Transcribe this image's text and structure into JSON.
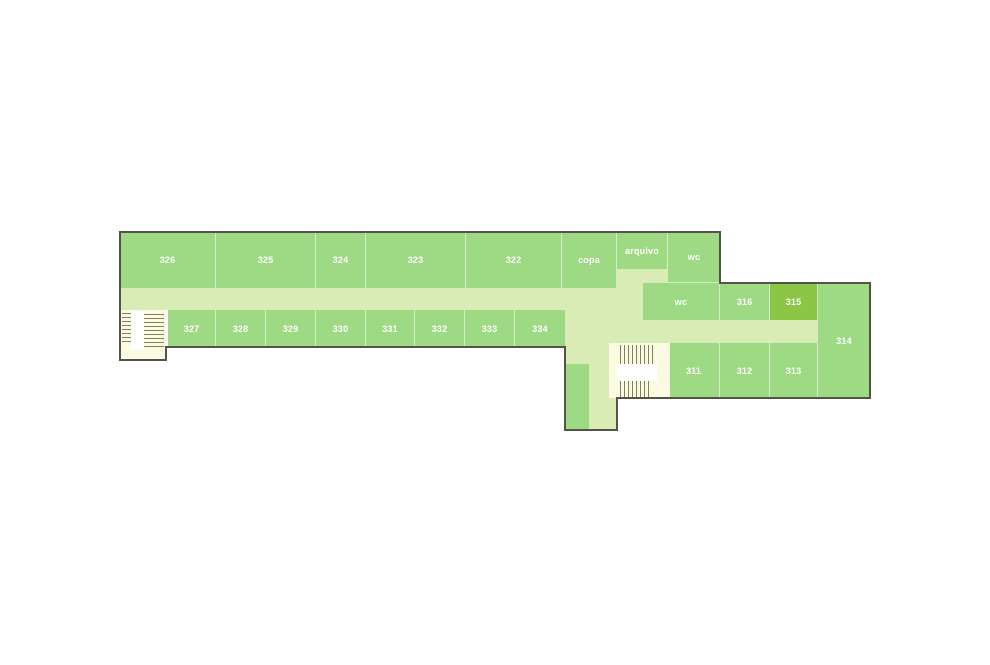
{
  "title": "floor-plan-third-floor",
  "selected_room": "315",
  "colors": {
    "room_green": "#9dda83",
    "room_selected": "#8cc647",
    "corridor_green": "#d9ecb6",
    "stair_cream": "#fbfae3",
    "stair_landing": "#ffffff",
    "tread": "#80805a",
    "outline": "#53534a",
    "background": "#ffffff"
  },
  "rooms": {
    "r326": "326",
    "r325": "325",
    "r324": "324",
    "r323": "323",
    "r322": "322",
    "copa": "copa",
    "arquivo": "arquivo",
    "wc_top": "wc",
    "r327": "327",
    "r328": "328",
    "r329": "329",
    "r330": "330",
    "r331": "331",
    "r332": "332",
    "r333": "333",
    "r334": "334",
    "wc_mid": "wc",
    "r316": "316",
    "r315": "315",
    "r314": "314",
    "r311": "311",
    "r312": "312",
    "r313": "313"
  }
}
